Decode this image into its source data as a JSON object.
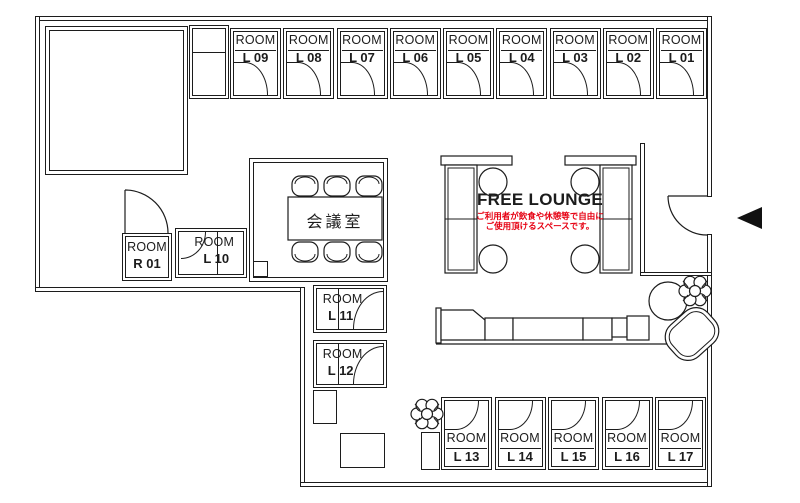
{
  "plan": {
    "meeting_room_label": "会議室",
    "lounge": {
      "title": "FREE LOUNGE",
      "note_line1": "ご利用者が飲食や休憩等で自由に",
      "note_line2": "ご使用頂けるスペースです。"
    },
    "rooms": {
      "top": [
        {
          "label": "ROOM",
          "number": "L 09"
        },
        {
          "label": "ROOM",
          "number": "L 08"
        },
        {
          "label": "ROOM",
          "number": "L 07"
        },
        {
          "label": "ROOM",
          "number": "L 06"
        },
        {
          "label": "ROOM",
          "number": "L 05"
        },
        {
          "label": "ROOM",
          "number": "L 04"
        },
        {
          "label": "ROOM",
          "number": "L 03"
        },
        {
          "label": "ROOM",
          "number": "L 02"
        },
        {
          "label": "ROOM",
          "number": "L 01"
        }
      ],
      "left_wing": [
        {
          "label": "ROOM",
          "number": "R 01"
        },
        {
          "label": "ROOM",
          "number": "L 10"
        }
      ],
      "middle": [
        {
          "label": "ROOM",
          "number": "L 11"
        },
        {
          "label": "ROOM",
          "number": "L 12"
        }
      ],
      "bottom": [
        {
          "label": "ROOM",
          "number": "L 13"
        },
        {
          "label": "ROOM",
          "number": "L 14"
        },
        {
          "label": "ROOM",
          "number": "L 15"
        },
        {
          "label": "ROOM",
          "number": "L 16"
        },
        {
          "label": "ROOM",
          "number": "L 17"
        }
      ]
    }
  },
  "icons": {
    "entrance_arrow": "left-filled-triangle",
    "plants": "potted-plant-scribble"
  },
  "colors": {
    "background": "#ffffff",
    "line": "#1c1c1c",
    "note_red": "#e60012"
  }
}
